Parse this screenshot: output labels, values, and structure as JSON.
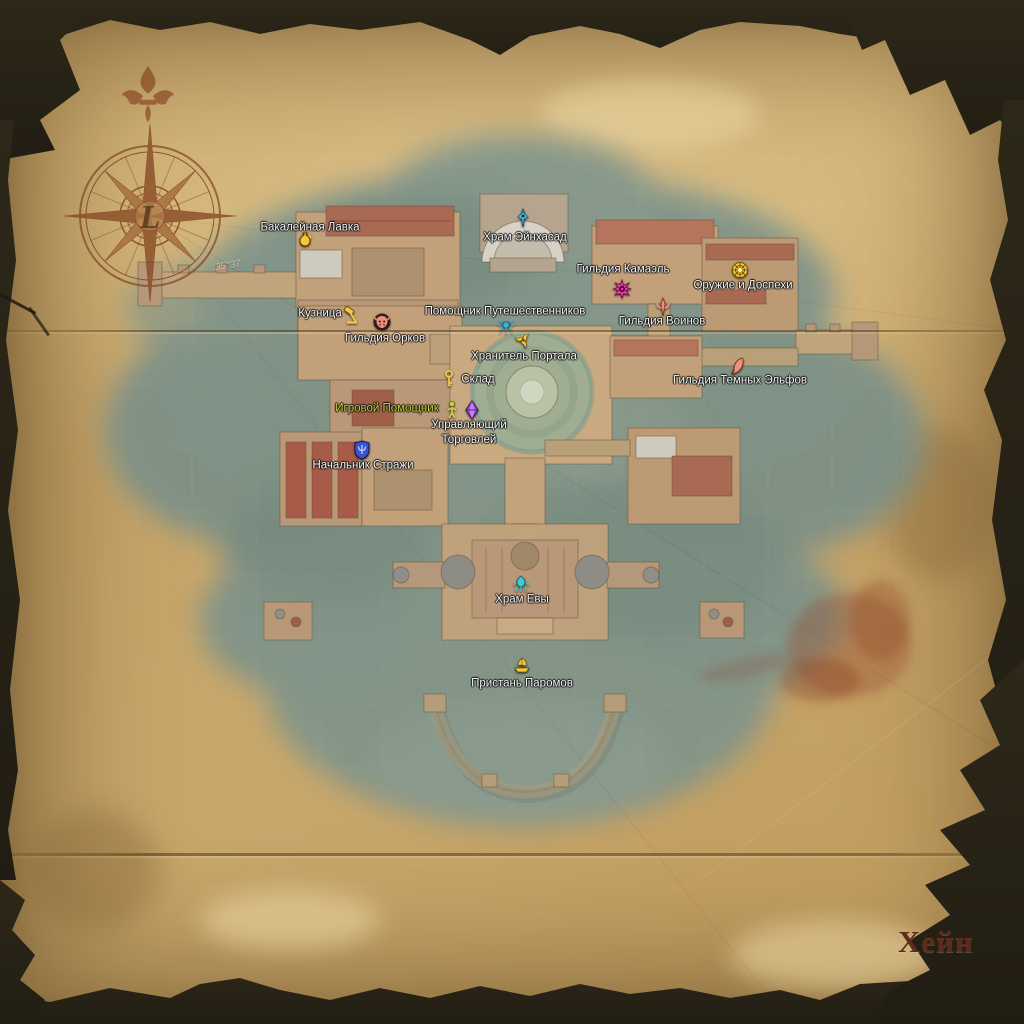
{
  "map": {
    "title": "Хейн",
    "compass": {
      "center_letter": "L"
    },
    "graticule_labels": [
      {
        "text": "35°37",
        "x": 228,
        "y": 266
      }
    ],
    "colors": {
      "label_default": "#f2f2f2",
      "assistant_text": "#c6cf3e",
      "gold_icon": "#f5c83e",
      "cyan_icon": "#4fd2ea",
      "magenta_icon": "#e83aa6",
      "salmon_icon": "#ef8f80",
      "purple_icon": "#a050e0",
      "blue_icon": "#3b53cc",
      "teal_icon": "#3cc8d4",
      "title_ink": "#5e2a1b",
      "water": "#7d938a",
      "parchment": "#c7a468"
    },
    "markers": [
      {
        "id": "grocery-shop",
        "label": "Бакалейная Лавка",
        "icon": "jug-icon",
        "icon_color": "#f5c83e",
        "icon_x": 305,
        "icon_y": 240,
        "label_x": 310,
        "label_y": 228
      },
      {
        "id": "einhasad-temple",
        "label": "Храм Эйнхасад",
        "icon": "temple-sigil-icon",
        "icon_color": "#4fd2ea",
        "icon_x": 523,
        "icon_y": 218,
        "label_x": 525,
        "label_y": 238
      },
      {
        "id": "kamael-guild",
        "label": "Гильдия Камаэль",
        "icon": "spiked-sigil-icon",
        "icon_color": "#e83aa6",
        "icon_x": 622,
        "icon_y": 289,
        "label_x": 623,
        "label_y": 270
      },
      {
        "id": "weapons-armor-shop",
        "label": "Оружие и Доспехи",
        "icon": "round-shield-icon",
        "icon_color": "#f5c83e",
        "icon_x": 740,
        "icon_y": 270,
        "label_x": 743,
        "label_y": 286
      },
      {
        "id": "warrior-guild",
        "label": "Гильдия Воинов",
        "icon": "trident-sigil-icon",
        "icon_color": "#ef8f80",
        "icon_x": 663,
        "icon_y": 307,
        "label_x": 662,
        "label_y": 322
      },
      {
        "id": "blacksmith",
        "label": "Кузница",
        "icon": "hammer-icon",
        "icon_color": "#f5c83e",
        "icon_x": 352,
        "icon_y": 315,
        "label_x": 320,
        "label_y": 314
      },
      {
        "id": "orc-guild",
        "label": "Гильдия Орков",
        "icon": "orc-face-icon",
        "icon_color": "#ef8f80",
        "icon_x": 382,
        "icon_y": 322,
        "label_x": 385,
        "label_y": 339
      },
      {
        "id": "traveler-assistant",
        "label": "Помощник Путешественников",
        "icon": "teleport-sigil-icon",
        "icon_color": "#35b8e8",
        "icon_x": 506,
        "icon_y": 328,
        "label_x": 505,
        "label_y": 312
      },
      {
        "id": "gatekeeper",
        "label": "Хранитель Портала",
        "icon": "triple-swirl-icon",
        "icon_color": "#f5c83e",
        "icon_x": 523,
        "icon_y": 340,
        "label_x": 524,
        "label_y": 357
      },
      {
        "id": "warehouse",
        "label": "Склад",
        "icon": "key-icon",
        "icon_color": "#f5c83e",
        "icon_x": 449,
        "icon_y": 379,
        "label_x": 478,
        "label_y": 380
      },
      {
        "id": "dark-elf-guild",
        "label": "Гильдия Темных Эльфов",
        "icon": "curved-blade-icon",
        "icon_color": "#ef8f80",
        "icon_x": 738,
        "icon_y": 366,
        "label_x": 740,
        "label_y": 381
      },
      {
        "id": "game-assistant",
        "label": "Игровой Помощник",
        "icon": "person-icon",
        "icon_color": "#c6cf3e",
        "icon_x": 452,
        "icon_y": 410,
        "label_x": 387,
        "label_y": 409,
        "label_color": "#c6cf3e"
      },
      {
        "id": "trade-manager",
        "label": "Управляющий Торговлей",
        "label_lines": [
          "Управляющий",
          "Торговлей"
        ],
        "icon": "gem-icon",
        "icon_color": "#a050e0",
        "icon_x": 472,
        "icon_y": 410,
        "label_x": 469,
        "label_y": 433
      },
      {
        "id": "guard-captain",
        "label": "Начальник Стражи",
        "icon": "shield-trident-icon",
        "icon_color": "#3b53cc",
        "icon_x": 362,
        "icon_y": 450,
        "label_x": 363,
        "label_y": 466
      },
      {
        "id": "eva-temple",
        "label": "Храм Евы",
        "icon": "fountain-sigil-icon",
        "icon_color": "#3cc8d4",
        "icon_x": 521,
        "icon_y": 584,
        "label_x": 522,
        "label_y": 600
      },
      {
        "id": "ferry-wharf",
        "label": "Пристань Паромов",
        "icon": "ship-icon",
        "icon_color": "#f5c83e",
        "icon_x": 522,
        "icon_y": 665,
        "label_x": 522,
        "label_y": 684
      }
    ]
  }
}
